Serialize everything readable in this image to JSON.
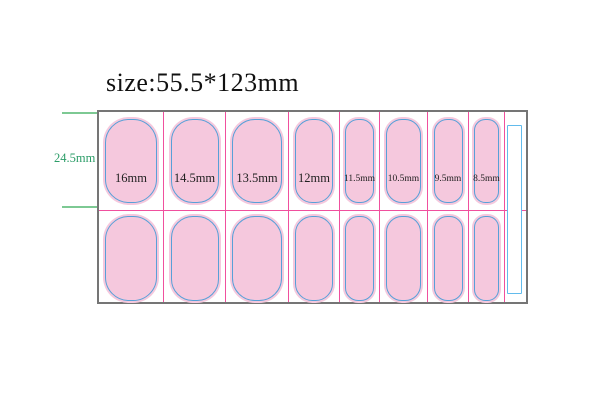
{
  "title": "size:55.5*123mm",
  "dimension_label": "24.5mm",
  "colors": {
    "outline": "#757575",
    "magenta": "#f0509e",
    "nail_fill": "#f5c8dd",
    "nail_stroke": "#57a0d8",
    "slot_stroke": "#62bbec",
    "green_line": "#7dc993",
    "green_text": "#2c9d68",
    "label_text": "#1f1f1f",
    "title_text": "#111111"
  },
  "sheet": {
    "x": 97,
    "y": 110,
    "w": 431,
    "h": 194,
    "row_divider_y": 98
  },
  "nail_rows": {
    "row1_top": 5,
    "row1_h": 88,
    "row2_top": 102,
    "row2_h": 89
  },
  "slot": {
    "x": 408,
    "y": 13,
    "w": 15,
    "h": 169
  },
  "columns": [
    {
      "label": "16mm",
      "x": 97,
      "w": 65,
      "nail_w": 56,
      "font": 12.5
    },
    {
      "label": "14.5mm",
      "x": 162,
      "w": 62,
      "nail_w": 52,
      "font": 12.5
    },
    {
      "label": "13.5mm",
      "x": 224,
      "w": 63,
      "nail_w": 54,
      "font": 12.5
    },
    {
      "label": "12mm",
      "x": 287,
      "w": 51,
      "nail_w": 42,
      "font": 12.5
    },
    {
      "label": "11.5mm",
      "x": 338,
      "w": 40,
      "nail_w": 33,
      "font": 9.5
    },
    {
      "label": "10.5mm",
      "x": 378,
      "w": 48,
      "nail_w": 39,
      "font": 9.5
    },
    {
      "label": "9.5mm",
      "x": 426,
      "w": 41,
      "nail_w": 33,
      "font": 9.5
    },
    {
      "label": "8.5mm",
      "x": 467,
      "w": 36,
      "nail_w": 29,
      "font": 9.5
    }
  ]
}
